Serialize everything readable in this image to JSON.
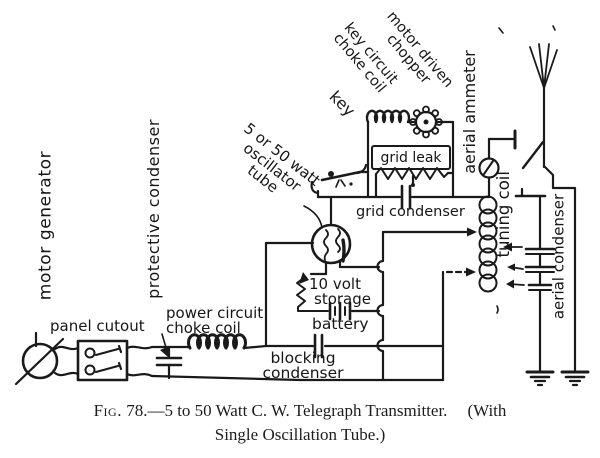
{
  "colors": {
    "ink": "#1a1a1a",
    "paper": "#ffffff"
  },
  "labels": {
    "motor_generator": "motor generator",
    "protective_condenser": "protective condenser",
    "panel_cutout": "panel cutout",
    "power_circuit_choke_coil": [
      "power circuit",
      "choke coil"
    ],
    "blocking_condenser": [
      "blocking",
      "condenser"
    ],
    "storage_battery": [
      "10 volt",
      "storage"
    ],
    "battery": "battery",
    "grid_leak": "grid leak",
    "grid_condenser": "grid condenser",
    "oscillator_tube": [
      "5 or 50 watt",
      "oscillator",
      "tube"
    ],
    "key": "key",
    "key_circuit_choke_coil": [
      "key circuit",
      "choke coil"
    ],
    "motor_driven_chopper": [
      "motor driven",
      "chopper"
    ],
    "aerial_ammeter": "aerial ammeter",
    "tuning_coil": "tuning coil",
    "aerial_condenser": "aerial condenser"
  },
  "caption": {
    "fig_label": "Fig.",
    "line1": "78.—5 to 50 Watt C. W. Telegraph Transmitter.",
    "line1_suffix": "(With",
    "line2": "Single Oscillation Tube.)"
  }
}
